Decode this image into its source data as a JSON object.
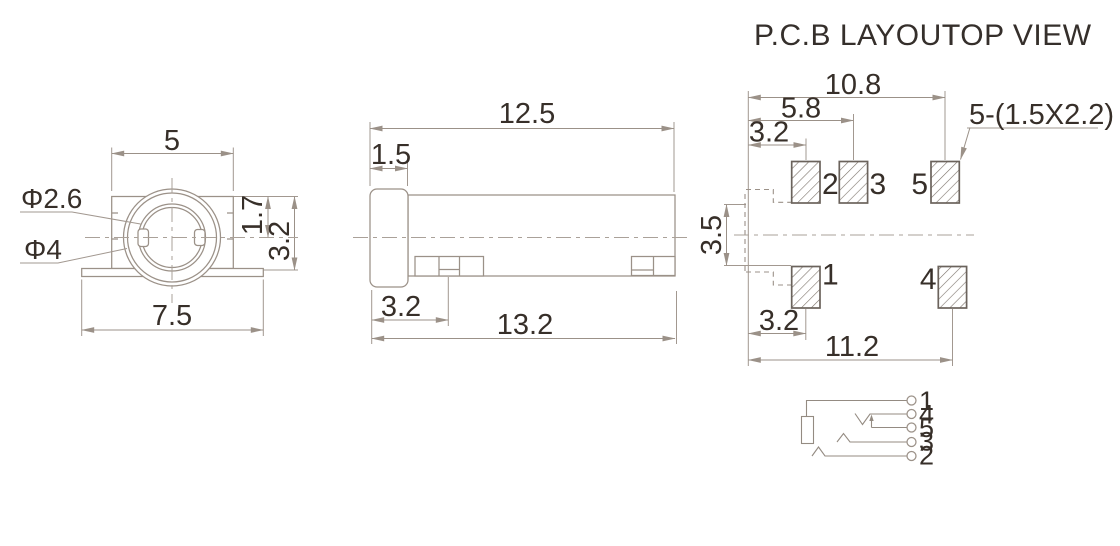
{
  "front_view": {
    "dim_barrel_width": "5",
    "dim_base_width": "7.5",
    "dim_center_height": "1.7",
    "dim_body_height": "3.2",
    "label_inner_diameter": "Φ2.6",
    "label_outer_diameter": "Φ4"
  },
  "side_view": {
    "dim_body_length": "12.5",
    "dim_bezel_thickness": "1.5",
    "dim_pin_offset": "3.2",
    "dim_overall_length": "13.2"
  },
  "pcb_layout": {
    "heading_left": "P.C.B LAYOUT",
    "heading_right": "TOP VIEW",
    "dim_pad5_offset": "10.8",
    "dim_pad3_offset": "5.8",
    "dim_pad2_offset": "3.2",
    "dim_row_spacing": "3.5",
    "dim_pad1_offset": "3.2",
    "dim_pad4_offset": "11.2",
    "pad_size_note": "5-(1.5X2.2)",
    "pad_labels": {
      "pad1": "1",
      "pad2": "2",
      "pad3": "3",
      "pad4": "4",
      "pad5": "5"
    }
  },
  "schematic": {
    "terminal_labels": [
      "1",
      "4",
      "5",
      "3",
      "2"
    ]
  },
  "colors": {
    "line": "#9b9188",
    "text": "#372f29"
  }
}
